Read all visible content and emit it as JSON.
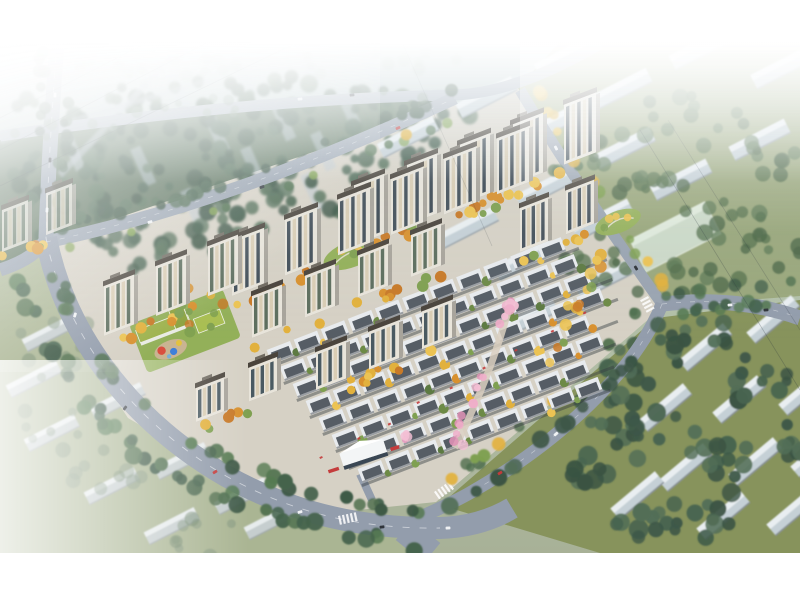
{
  "image": {
    "title": "Aerial bird's-eye architectural rendering of a residential development masterplan",
    "subject": "photorealistic rendering, no on-screen text or UI controls",
    "width_px": 800,
    "height_px": 600,
    "letterbox": {
      "top_px": 42,
      "bottom_px": 47
    }
  },
  "palette": {
    "letterbox": "#ffffff",
    "haze": "#ffffff",
    "sky_tint": "#c3d5de",
    "road": "#939dac",
    "road_hazy": "#a6b0bc",
    "road_dash": "#f2f4f6",
    "canopy_dark": "#566e57",
    "tree_dark": "#3d5a44",
    "tree_green": "#4f6f4c",
    "tree_autumn_yellow": "#e2b13d",
    "tree_autumn_orange": "#d8912f",
    "tree_blossom_pink": "#efaec9",
    "tower_facade": "#e8e4da",
    "tower_window": "#3e4a54",
    "tower_roof": "#4a443c",
    "tower_warm_stripe": "#d9cdb4",
    "townhouse_roof": "#e8ebee",
    "townhouse_panel": "#3c444c",
    "kindergarten_roof": "#9db24c",
    "lawn_bright": "#8fae53",
    "commercial_roof": "#f3f5f6",
    "accent_red": "#c43c3c",
    "city_slab": "#c5d0d6",
    "city_slab_top": "#e9eef1",
    "grass_ne": "#9aa77c",
    "grass_se": "#87935c",
    "grass_sw": "#aab593",
    "site_ground": "#d6d1c5"
  },
  "scene": {
    "development_site": {
      "residential_tower_rows": 8,
      "residential_towers": 27,
      "townhouse_rows": 8,
      "kindergarten": "low-rise with olive-green roofs, bright lawn and colorful playground",
      "commercial_pavilion": "white folded-roof pavilion on the south ring road with red storefront accents",
      "landscape_features": [
        "autumn yellow tree bands between rows",
        "pink blossom central axis",
        "green pocket parks"
      ]
    },
    "surroundings": {
      "northwest": "dense dark tree canopy with faint city slabs, crossing streets and power lines",
      "northeast": "hazy grid of low slab buildings on olive grass with a pale green flat-roof hall",
      "southwest": "hazy rows of low slab buildings and lawns beyond the curving boulevard",
      "southeast": "rows of gable-roof slab buildings among dense green trees"
    },
    "roads": [
      "left highway",
      "curving tree-lined boulevard",
      "upper boundary road",
      "right boundary road",
      "east crossing road"
    ],
    "atmosphere": [
      "white letterbox top and bottom",
      "strong white haze toward the top",
      "light flare from the upper-left corner",
      "traffic dots on all roads"
    ]
  }
}
